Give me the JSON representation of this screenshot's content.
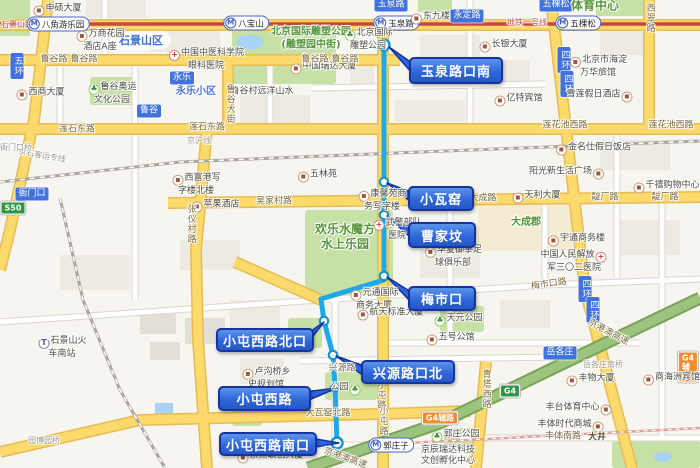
{
  "colors": {
    "route_blue": "#1FA8E5",
    "callout_blue": "#2F68D9",
    "callout_border": "#16339E",
    "metro_line_red": "#C74840",
    "road_yellow": "#FBD96B",
    "park_green": "#C7E0A5",
    "expressway_green": "#9CC47E",
    "badge_blue": "#4172DD"
  },
  "route": {
    "path": [
      [
        384,
        45
      ],
      [
        384,
        280
      ],
      [
        321,
        299
      ],
      [
        324,
        321
      ],
      [
        333,
        355
      ],
      [
        335,
        387
      ],
      [
        337,
        443
      ]
    ],
    "stops": [
      {
        "x": 384,
        "y": 45,
        "terminal": true
      },
      {
        "x": 384,
        "y": 182
      },
      {
        "x": 384,
        "y": 215
      },
      {
        "x": 384,
        "y": 276
      },
      {
        "x": 324,
        "y": 321
      },
      {
        "x": 333,
        "y": 355
      },
      {
        "x": 335,
        "y": 387
      },
      {
        "x": 337,
        "y": 443,
        "terminal": true
      }
    ],
    "callouts": [
      {
        "label": "玉泉路口南",
        "x": 409,
        "y": 57,
        "w": 90,
        "h": 23,
        "apex": [
          389,
          47
        ],
        "edge": "left"
      },
      {
        "label": "小瓦窑",
        "x": 408,
        "y": 186,
        "w": 62,
        "h": 21,
        "apex": [
          387,
          183
        ],
        "edge": "left"
      },
      {
        "label": "曹家坟",
        "x": 408,
        "y": 222,
        "w": 64,
        "h": 22,
        "apex": [
          387,
          216
        ],
        "edge": "left"
      },
      {
        "label": "梅市口",
        "x": 408,
        "y": 286,
        "w": 64,
        "h": 21,
        "apex": [
          387,
          277
        ],
        "edge": "left"
      },
      {
        "label": "小屯西路北口",
        "x": 216,
        "y": 328,
        "w": 94,
        "h": 20,
        "apex": [
          324,
          322
        ],
        "edge": "right"
      },
      {
        "label": "兴源路口北",
        "x": 361,
        "y": 360,
        "w": 90,
        "h": 20,
        "apex": [
          336,
          356
        ],
        "edge": "left"
      },
      {
        "label": "小屯西路",
        "x": 218,
        "y": 386,
        "w": 89,
        "h": 21,
        "apex": [
          337,
          388
        ],
        "edge": "right"
      },
      {
        "label": "小屯西路南口",
        "x": 219,
        "y": 432,
        "w": 94,
        "h": 20,
        "apex": [
          339,
          443
        ],
        "edge": "right"
      }
    ]
  },
  "map_labels": [
    {
      "t": "rail",
      "text": "石景山路",
      "x": 17,
      "y": 25
    },
    {
      "t": "station",
      "text": "八角游乐园",
      "x": 58,
      "y": 24
    },
    {
      "t": "station",
      "text": "八宝山",
      "x": 246,
      "y": 23
    },
    {
      "t": "station",
      "text": "玉泉路",
      "x": 396,
      "y": 23
    },
    {
      "t": "station",
      "text": "五棵松",
      "x": 578,
      "y": 23
    },
    {
      "t": "station",
      "text": "郭庄子",
      "x": 391,
      "y": 445
    },
    {
      "t": "rail",
      "text": "地铁一号线",
      "x": 527,
      "y": 23
    },
    {
      "t": "badge",
      "text": "玉泉路",
      "x": 391,
      "y": 5
    },
    {
      "t": "badge",
      "text": "永定路",
      "x": 467,
      "y": 16
    },
    {
      "t": "badge",
      "text": "五棵松",
      "x": 556,
      "y": 5
    },
    {
      "t": "badge",
      "text": "永乐",
      "x": 182,
      "y": 78
    },
    {
      "t": "badge",
      "text": "鲁谷",
      "x": 149,
      "y": 111
    },
    {
      "t": "badge",
      "text": "衙门口",
      "x": 32,
      "y": 194
    },
    {
      "t": "badge",
      "text": "岳各庄",
      "x": 560,
      "y": 353
    },
    {
      "t": "badge-v",
      "text": "五环",
      "x": 17,
      "y": 66
    },
    {
      "t": "badge-v",
      "text": "四环",
      "x": 564,
      "y": 60
    },
    {
      "t": "badge-v",
      "text": "四环",
      "x": 567,
      "y": 84
    },
    {
      "t": "badge-v",
      "text": "四环",
      "x": 585,
      "y": 289
    },
    {
      "t": "badge-v",
      "text": "四环",
      "x": 593,
      "y": 310
    },
    {
      "t": "shield-green",
      "text": "S50",
      "x": 13,
      "y": 208
    },
    {
      "t": "shield-green",
      "text": "G4",
      "x": 510,
      "y": 391
    },
    {
      "t": "shield-orange",
      "text": "G4辅路",
      "x": 440,
      "y": 418
    },
    {
      "t": "shield-orange",
      "text": "G4辅路",
      "x": 688,
      "y": 367
    },
    {
      "t": "district",
      "text": "石景山区",
      "x": 141,
      "y": 40
    },
    {
      "t": "green-mid",
      "lines": [
        "北京国际雕塑公园",
        "(雕塑园中街)"
      ],
      "x": 311,
      "y": 39
    },
    {
      "t": "green-big",
      "lines": [
        "欢乐水魔方",
        "水上乐园"
      ],
      "x": 345,
      "y": 237
    },
    {
      "t": "green-big",
      "text": "体育中心",
      "x": 595,
      "y": 6
    },
    {
      "t": "green-mid",
      "text": "大成郡",
      "x": 526,
      "y": 223
    },
    {
      "t": "bluetext",
      "text": "永乐小区",
      "x": 196,
      "y": 92
    },
    {
      "t": "poi",
      "text": "申硕大厦",
      "x": 57,
      "y": 10,
      "icon": "building"
    },
    {
      "t": "poi",
      "lines": [
        "万商花园",
        "酒店A座"
      ],
      "x": 100,
      "y": 41,
      "icon": "building"
    },
    {
      "t": "poi",
      "lines": [
        "中国中医科学院",
        "眼科医院"
      ],
      "x": 206,
      "y": 60,
      "icon": "hospital"
    },
    {
      "t": "poi",
      "text": "西商大厦",
      "x": 40,
      "y": 94,
      "icon": "building"
    },
    {
      "t": "poi",
      "lines": [
        "鲁谷奥运",
        "文化公园"
      ],
      "x": 112,
      "y": 94,
      "icon": "tree"
    },
    {
      "t": "poi-plain",
      "text": "鲁谷村远洋山水",
      "x": 262,
      "y": 92
    },
    {
      "t": "poi",
      "text": "中国瑞达大厦",
      "x": 323,
      "y": 68,
      "icon": "building"
    },
    {
      "t": "poi",
      "lines": [
        "北京国际",
        "雕塑公园"
      ],
      "x": 368,
      "y": 40,
      "icon": "tree"
    },
    {
      "t": "poi",
      "text": "东九楼",
      "x": 430,
      "y": 18,
      "icon": "building"
    },
    {
      "t": "poi",
      "text": "长银大厦",
      "x": 503,
      "y": 46,
      "icon": "building"
    },
    {
      "t": "poi",
      "lines": [
        "北京市海淀",
        "万华旅馆"
      ],
      "x": 598,
      "y": 67,
      "icon": "building"
    },
    {
      "t": "poi",
      "text": "亿特宾馆",
      "x": 518,
      "y": 100,
      "icon": "building"
    },
    {
      "t": "poi",
      "text": "雪莲假日酒店",
      "x": 600,
      "y": 96,
      "icon": "building",
      "side": "r"
    },
    {
      "t": "poi",
      "text": "金名仕假日饭店",
      "x": 593,
      "y": 149,
      "icon": "building"
    },
    {
      "t": "poi",
      "text": "阳光新生活广场",
      "x": 567,
      "y": 173,
      "icon": "building",
      "side": "r"
    },
    {
      "t": "poi",
      "text": "千禧购物中心",
      "x": 666,
      "y": 187,
      "icon": "building"
    },
    {
      "t": "poi",
      "text": "天利大厦",
      "x": 536,
      "y": 197,
      "icon": "building"
    },
    {
      "t": "poi",
      "lines": [
        "西富港写",
        "字楼北楼"
      ],
      "x": 196,
      "y": 185,
      "icon": "building"
    },
    {
      "t": "poi",
      "text": "苹果酒店",
      "x": 215,
      "y": 206,
      "icon": "building"
    },
    {
      "t": "poi",
      "text": "五林苑",
      "x": 317,
      "y": 176,
      "icon": "building"
    },
    {
      "t": "poi",
      "lines": [
        "康馨苑商",
        "务写字楼"
      ],
      "x": 382,
      "y": 201,
      "icon": "building"
    },
    {
      "t": "poi",
      "lines": [
        "武警部队",
        "医院"
      ],
      "x": 397,
      "y": 230,
      "icon": "hospital"
    },
    {
      "t": "poi",
      "lines": [
        "华夏御拳足",
        "球俱乐部"
      ],
      "x": 453,
      "y": 257,
      "icon": "building"
    },
    {
      "t": "poi",
      "text": "宇通商务楼",
      "x": 576,
      "y": 240,
      "icon": "building"
    },
    {
      "t": "poi",
      "lines": [
        "中国人民解放",
        "军三〇二医院"
      ],
      "x": 574,
      "y": 262,
      "icon": "hospital",
      "side": "r"
    },
    {
      "t": "poi",
      "lines": [
        "元通国际",
        "商务大厦"
      ],
      "x": 374,
      "y": 300,
      "icon": "building"
    },
    {
      "t": "poi",
      "text": "航天标准大厦",
      "x": 390,
      "y": 314,
      "icon": "building"
    },
    {
      "t": "poi",
      "text": "五号公馆",
      "x": 450,
      "y": 339,
      "icon": "building"
    },
    {
      "t": "poi",
      "text": "天元公园",
      "x": 458,
      "y": 320,
      "icon": "tree"
    },
    {
      "t": "poi",
      "lines": [
        "卢沟桥乡",
        "史规划馆"
      ],
      "x": 266,
      "y": 379,
      "icon": "building"
    },
    {
      "t": "poi",
      "text": "公园",
      "x": 346,
      "y": 389,
      "icon": "tree",
      "side": "r"
    },
    {
      "t": "poi",
      "text": "丰物大厦",
      "x": 590,
      "y": 380,
      "icon": "building"
    },
    {
      "t": "poi",
      "text": "商海洲宾馆",
      "x": 671,
      "y": 379,
      "icon": "building"
    },
    {
      "t": "poi",
      "text": "丰台体育中心",
      "x": 579,
      "y": 409,
      "icon": "building",
      "side": "r"
    },
    {
      "t": "poi",
      "text": "丰体时代商城",
      "x": 571,
      "y": 426,
      "icon": "building",
      "side": "r"
    },
    {
      "t": "poi",
      "text": "郭庄公园",
      "x": 455,
      "y": 436,
      "icon": "tree"
    },
    {
      "t": "poi-plain",
      "lines": [
        "京辰瑞达科技",
        "文创孵化中心"
      ],
      "x": 448,
      "y": 456
    },
    {
      "t": "poi",
      "text": "京点联创大厦",
      "x": 270,
      "y": 457,
      "icon": "building"
    },
    {
      "t": "poi",
      "lines": [
        "石景山火",
        "车南站"
      ],
      "x": 62,
      "y": 348,
      "icon": "train"
    },
    {
      "t": "road",
      "text": "鲁谷路",
      "x": 54,
      "y": 60
    },
    {
      "t": "road",
      "text": "鲁谷路",
      "x": 84,
      "y": 60
    },
    {
      "t": "road",
      "text": "鲁谷路",
      "x": 315,
      "y": 60
    },
    {
      "t": "road",
      "text": "鲁谷路",
      "x": 345,
      "y": 60
    },
    {
      "t": "road",
      "text": "莲石东路",
      "x": 77,
      "y": 130
    },
    {
      "t": "road",
      "text": "莲石东路",
      "x": 207,
      "y": 128
    },
    {
      "t": "road",
      "text": "莲花池西路",
      "x": 565,
      "y": 126
    },
    {
      "t": "road",
      "text": "莲花池西路",
      "x": 671,
      "y": 126
    },
    {
      "t": "road",
      "text": "吴家村路",
      "x": 274,
      "y": 202
    },
    {
      "t": "road",
      "text": "大成路",
      "x": 483,
      "y": 199
    },
    {
      "t": "road",
      "text": "靛厂路",
      "x": 605,
      "y": 198
    },
    {
      "t": "road",
      "text": "靛厂路",
      "x": 665,
      "y": 198
    },
    {
      "t": "road",
      "text": "梅市口路",
      "x": 549,
      "y": 285,
      "rot": -8
    },
    {
      "t": "road",
      "text": "兴源路",
      "x": 342,
      "y": 369
    },
    {
      "t": "road",
      "text": "大瓦窑北路",
      "x": 328,
      "y": 414
    },
    {
      "t": "road",
      "text": "丰体南路",
      "x": 563,
      "y": 437
    },
    {
      "t": "road-b",
      "text": "大井",
      "x": 597,
      "y": 438
    },
    {
      "t": "road-v",
      "text": "张仪村路",
      "x": 190,
      "y": 224
    },
    {
      "t": "road-v",
      "text": "鲁谷大街",
      "x": 229,
      "y": 104
    },
    {
      "t": "road-v",
      "text": "小屯路",
      "x": 380,
      "y": 395
    },
    {
      "t": "road-v",
      "text": "小屯路",
      "x": 382,
      "y": 421
    },
    {
      "t": "road-v",
      "text": "西翠路",
      "x": 649,
      "y": 18
    },
    {
      "t": "road-v",
      "text": "青塔西路",
      "x": 485,
      "y": 389
    },
    {
      "t": "road",
      "text": "京港澳高速",
      "x": 608,
      "y": 333,
      "rot": 28
    },
    {
      "t": "road",
      "text": "京港澳高速",
      "x": 345,
      "y": 459,
      "rot": 20
    },
    {
      "t": "gray",
      "text": "京石客运专线",
      "x": 42,
      "y": 156,
      "rot": 10
    },
    {
      "t": "gray",
      "text": "京沪线",
      "x": 199,
      "y": 141
    },
    {
      "t": "gray",
      "text": "衙门口桥",
      "x": 16,
      "y": 148
    },
    {
      "t": "gray",
      "text": "园博园桥",
      "x": 44,
      "y": 441
    },
    {
      "t": "gray",
      "text": "岳各庄南桥",
      "x": 603,
      "y": 365
    }
  ]
}
